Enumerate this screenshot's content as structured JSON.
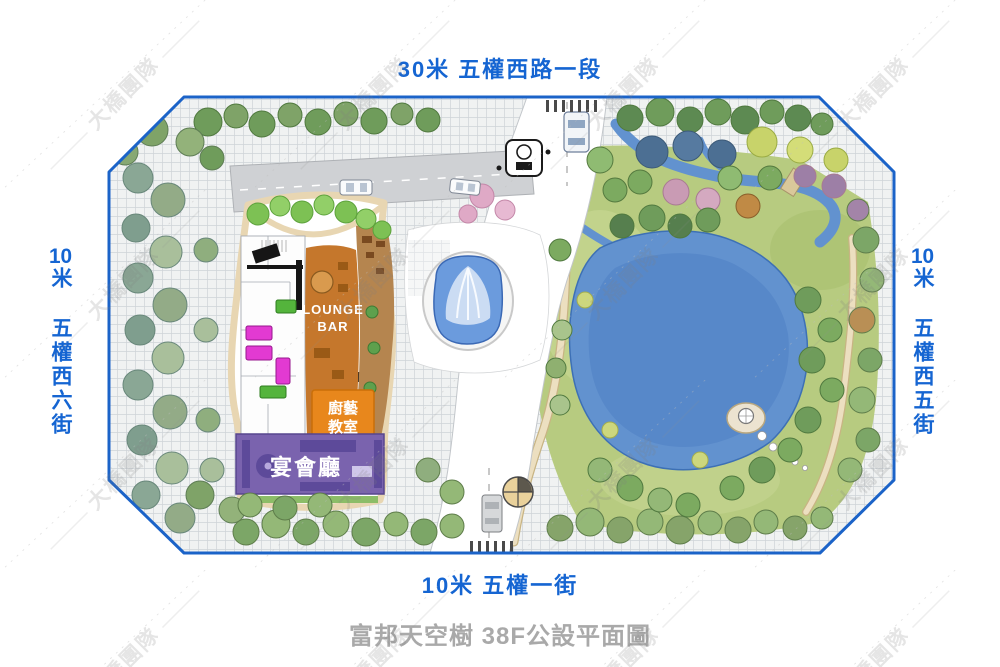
{
  "page": {
    "title": "富邦天空樹 38F公設平面圖",
    "watermark": "大橋團隊"
  },
  "streets": {
    "top": "30米 五權西路一段",
    "bottom": "10米 五權一街",
    "left_num": "10",
    "left_rest": "米 五權西六街",
    "right_num": "10",
    "right_rest": "米 五權西五街"
  },
  "rooms": {
    "lounge_line1": "LOUNGE",
    "lounge_line2": "BAR",
    "kitchen_line1": "廚藝",
    "kitchen_line2": "教室",
    "banquet": "宴會廳"
  },
  "colors": {
    "street_label_blue": "#1565d2",
    "title_gray": "#a9a9a9",
    "boundary_blue": "#1b63c8",
    "pond_blue": "#6292cf",
    "pool_blue": "#6b9bdd",
    "lounge_orange": "#c5772c",
    "kitchen_orange": "#e8871c",
    "banquet_purple": "#7a63ae",
    "lawn_green": "#b7cb80"
  }
}
